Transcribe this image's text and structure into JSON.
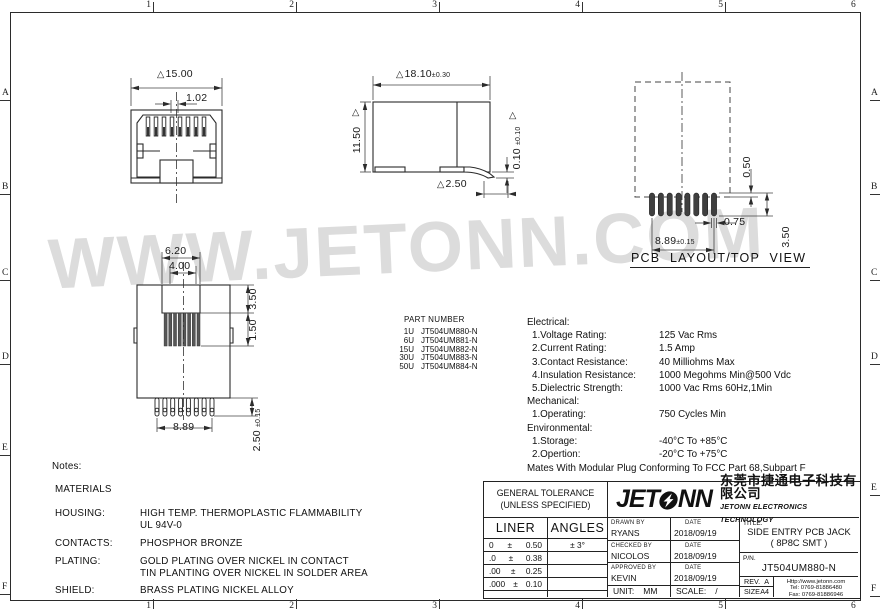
{
  "colors": {
    "line": "#2b2b2b",
    "watermark": "#dcdcdc"
  },
  "icons": {
    "datum_triangle": "△"
  },
  "watermark": "WWW.JETONN.COM",
  "frame": {
    "cols": [
      "1",
      "2",
      "3",
      "4",
      "5",
      "6"
    ],
    "rows": [
      "A",
      "B",
      "C",
      "D",
      "E",
      "F"
    ]
  },
  "views": {
    "front": {
      "width": "15.00",
      "pitch": "1.02"
    },
    "side": {
      "width": "18.10",
      "width_tol": "±0.30",
      "height": "11.50",
      "standoff": "0.10",
      "standoff_tol": "±0.10",
      "pad": "2.50"
    },
    "pcb": {
      "caption": "PCB LAYOUT/TOP VIEW",
      "gap": "0.50",
      "pad_width": "0.75",
      "span": "8.89",
      "span_tol": "±0.15",
      "pad_len": "3.50"
    },
    "bottom": {
      "shroud": "6.20",
      "opening": "4.00",
      "depth": "3.50",
      "tip": "1.50",
      "span": "8.89",
      "pin": "2.50",
      "pin_tol": "±0.15",
      "pin_count": 8
    }
  },
  "part_numbers": {
    "title": "PART NUMBER",
    "items": [
      {
        "code": "1U",
        "pn": "JT504UM880-N"
      },
      {
        "code": "6U",
        "pn": "JT504UM881-N"
      },
      {
        "code": "15U",
        "pn": "JT504UM882-N"
      },
      {
        "code": "30U",
        "pn": "JT504UM883-N"
      },
      {
        "code": "50U",
        "pn": "JT504UM884-N"
      }
    ]
  },
  "specs": {
    "electrical": {
      "heading": "Electrical:",
      "rows": [
        {
          "label": "1.Voltage Rating:",
          "value": "125 Vac Rms"
        },
        {
          "label": "2.Current Rating:",
          "value": "1.5 Amp"
        },
        {
          "label": "3.Contact Resistance:",
          "value": "40 Milliohms Max"
        },
        {
          "label": "4.Insulation Resistance:",
          "value": "1000 Megohms Min@500 Vdc"
        },
        {
          "label": "5.Dielectric Strength:",
          "value": "1000 Vac Rms 60Hz,1Min"
        }
      ]
    },
    "mechanical": {
      "heading": "Mechanical:",
      "rows": [
        {
          "label": "1.Operating:",
          "value": "750 Cycles Min"
        }
      ]
    },
    "environmental": {
      "heading": "Environmental:",
      "rows": [
        {
          "label": "1.Storage:",
          "value": "-40°C To +85°C"
        },
        {
          "label": "2.Opertion:",
          "value": "-20°C To +75°C"
        }
      ]
    },
    "footer": "Mates With Modular Plug Conforming To FCC Part 68,Subpart F"
  },
  "notes": {
    "title": "Notes:",
    "materials": "MATERIALS",
    "housing_label": "HOUSING:",
    "housing_line1": "HIGH TEMP. THERMOPLASTIC FLAMMABILITY",
    "housing_line2": "UL 94V-0",
    "contacts_label": "CONTACTS:",
    "contacts_line1": "PHOSPHOR BRONZE",
    "plating_label": "PLATING:",
    "plating_line1": "GOLD PLATING OVER NICKEL IN CONTACT",
    "plating_line2": "TIN PLANTING OVER NICKEL IN SOLDER AREA",
    "shield_label": "SHIELD:",
    "shield_line1": "BRASS PLATING NICKEL ALLOY"
  },
  "title_block": {
    "tolerance": {
      "line1": "GENERAL TOLERANCE",
      "line2": "(UNLESS SPECIFIED)",
      "liner": "LINER",
      "angles": "ANGLES",
      "rows": [
        {
          "range": "0",
          "pm": "±",
          "value": "0.50",
          "angle": "± 3°"
        },
        {
          "range": ".0",
          "pm": "±",
          "value": "0.38",
          "angle": ""
        },
        {
          "range": ".00",
          "pm": "±",
          "value": "0.25",
          "angle": ""
        },
        {
          "range": ".000",
          "pm": "±",
          "value": "0.10",
          "angle": ""
        }
      ]
    },
    "logo_part1": "JET",
    "logo_part2": "NN",
    "company_cn": "东莞市捷通电子科技有限公司",
    "company_en": "JETONN ELECTRONICS TECHNOLOGY",
    "sign_rows": [
      {
        "label": "DRAWN BY",
        "name": "RYANS",
        "date_label": "DATE",
        "date": "2018/09/19"
      },
      {
        "label": "CHECKED BY",
        "name": "NICOLOS",
        "date_label": "DATE",
        "date": "2018/09/19"
      },
      {
        "label": "APPROVED BY",
        "name": "KEVIN",
        "date_label": "DATE",
        "date": "2018/09/19"
      }
    ],
    "unit_label": "UNIT:",
    "unit": "MM",
    "scale_label": "SCALE:",
    "scale": "/",
    "title_label": "TITLE.",
    "title_line1": "SIDE ENTRY PCB JACK",
    "title_line2": "( 8P8C SMT )",
    "pn_label": "P/N.",
    "pn": "JT504UM880-N",
    "rev_label": "REV.",
    "rev": "A",
    "size_label": "SIZE",
    "size": "A4",
    "web": "Http://www.jetonn.com",
    "tel": "Tel:  0769-81886480",
    "fax": "Fax:  0769-81886946"
  }
}
